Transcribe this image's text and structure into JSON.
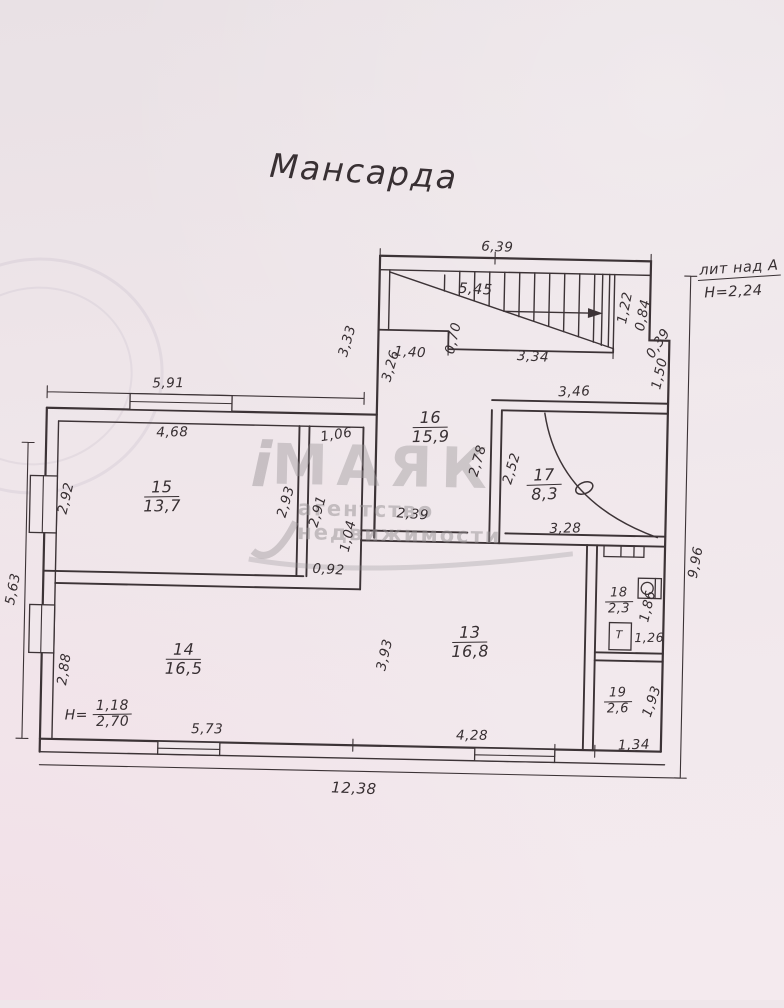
{
  "document": {
    "title": "Мансарда",
    "building_note": {
      "label": "лит над А",
      "height": "Н=2,24"
    }
  },
  "watermark": {
    "logo_i": "i",
    "brand": "МАЯК",
    "tagline": "агентство недвижимости"
  },
  "rooms": {
    "r13": {
      "number": "13",
      "area": "16,8"
    },
    "r14": {
      "number": "14",
      "area": "16,5",
      "height_note": {
        "prefix": "Н=",
        "top": "1,18",
        "bottom": "2,70"
      }
    },
    "r15": {
      "number": "15",
      "area": "13,7"
    },
    "r16": {
      "number": "16",
      "area": "15,9"
    },
    "r17": {
      "number": "17",
      "area": "8,3"
    },
    "r18": {
      "number": "18",
      "area": "2,3"
    },
    "r19": {
      "number": "19",
      "area": "2,6"
    }
  },
  "fixtures": {
    "toilet": "Т"
  },
  "dimensions": {
    "d639": "6,39",
    "d545": "5,45",
    "d122": "1,22",
    "d084": "0,84",
    "d039": "0,39",
    "d150": "1,50",
    "d334": "3,34",
    "d070": "0,70",
    "d140": "1,40",
    "d333": "3,33",
    "d326": "3,26",
    "d346": "3,46",
    "d591": "5,91",
    "d468": "4,68",
    "d106": "1,06",
    "d292": "2,92",
    "d293": "2,93",
    "d291": "2,91",
    "d104": "1,04",
    "d092": "0,92",
    "d278": "2,78",
    "d252": "2,52",
    "d328": "3,28",
    "d239": "2,39",
    "d563": "5,63",
    "d288": "2,88",
    "d573": "5,73",
    "d393": "3,93",
    "d428": "4,28",
    "d186": "1,86",
    "d126": "1,26",
    "d193": "1,93",
    "d134": "1,34",
    "d996": "9,96",
    "d1238": "12,38"
  },
  "colors": {
    "ink": "#3c3336",
    "paper": "#efe6ea",
    "watermark": "#b9b3b5"
  }
}
